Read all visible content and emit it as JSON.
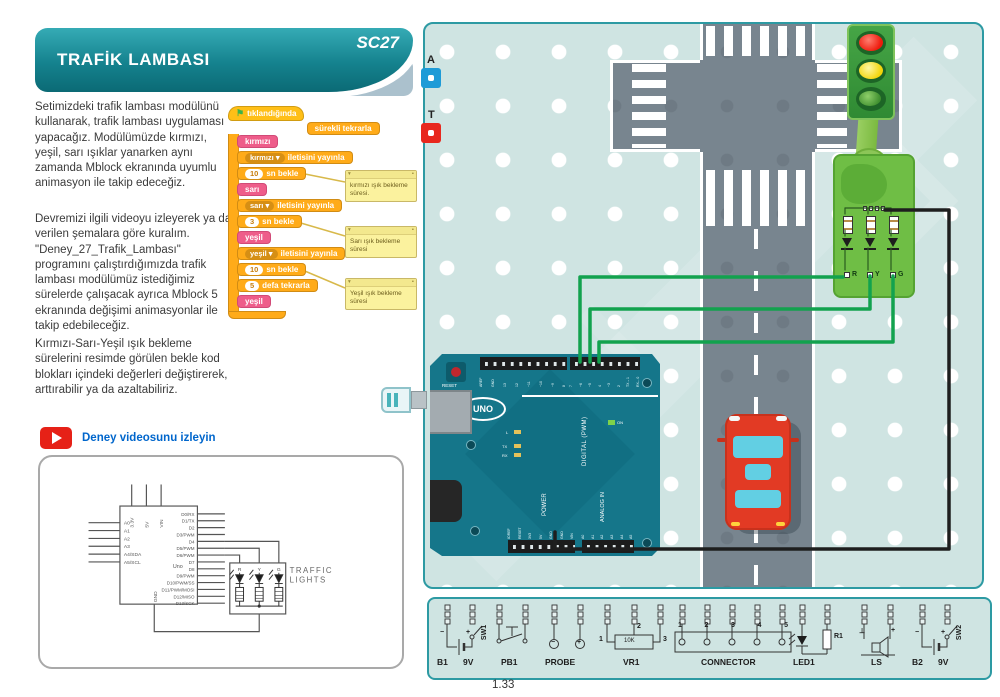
{
  "header": {
    "title": "TRAFİK LAMBASI",
    "code": "SC27"
  },
  "intro": {
    "p1": "Setimizdeki trafik lambası modülünü kullanarak, trafik lambası uygulaması yapacağız. Modülümüzde kırmızı, yeşil, sarı ışıklar yanarken aynı zamanda Mblock ekranında uyumlu animasyon ile takip edeceğiz.",
    "p2": "Devremizi ilgili videoyu izleyerek ya da verilen şemalara göre kuralım. \"Deney_27_Trafik_Lambası\" programını çalıştırdığımızda trafik lambası modülümüz istediğimiz sürelerde çalışacak ayrıca Mblock 5 ekranında değişimi animasyonlar ile takip edebileceğiz.",
    "p3": "Kırmızı-Sarı-Yeşil ışık bekleme sürelerini resimde görülen bekle kod blokları içindeki değerleri değiştirerek, arttırabilir ya da azaltabiliriz."
  },
  "video": {
    "label": "Deney videosunu izleyin"
  },
  "icons": {
    "green_flag": "⚑",
    "caret": "▾",
    "note_collapse": "▾",
    "note_mark": "▪"
  },
  "scratch": {
    "hat": "tıklandığında",
    "forever": "sürekli tekrarla",
    "rows": [
      {
        "text": "kırmızı"
      },
      {
        "dropdown": "kırmızı",
        "text": "iletisini yayınla"
      },
      {
        "value": "10",
        "text": "sn bekle"
      },
      {
        "text": "sarı"
      },
      {
        "dropdown": "sarı",
        "text": "iletisini yayınla"
      },
      {
        "value": "3",
        "text": "sn bekle"
      },
      {
        "text": "yeşil"
      },
      {
        "dropdown": "yeşil",
        "text": "iletisini yayınla"
      },
      {
        "value": "10",
        "text": "sn bekle"
      },
      {
        "value": "5",
        "text": "defa tekrarla"
      },
      {
        "text": "yeşil"
      }
    ],
    "notes": [
      "kırmızı ışık bekleme süresi.",
      "Sarı ışık bekleme süresi",
      "Yeşil ışık bekleme süresi"
    ]
  },
  "schematic": {
    "chip": "Uno",
    "gnd": "GND",
    "top_pins": [
      "3.3V",
      "5V",
      "VIN"
    ],
    "left_pins": [
      "A0",
      "A1",
      "A2",
      "A3",
      "A4/SDA",
      "A5/SCL"
    ],
    "right_pins": [
      "D0/RX",
      "D1/TX",
      "D2",
      "D3/PWM",
      "D4",
      "D5/PWM",
      "D6/PWM",
      "D7",
      "D8",
      "D9/PWM",
      "D10/PWM/SS",
      "D11/PWM/MOSI",
      "D12/MISO",
      "D13/SCK"
    ],
    "module_title1": "TRAFFIC",
    "module_title2": "LIGHTS",
    "leds": [
      "R",
      "Y",
      "G"
    ]
  },
  "board": {
    "marker_a": "A",
    "marker_t": "T",
    "module_leds": [
      "R",
      "Y",
      "G"
    ],
    "arduino": {
      "reset": "RESET",
      "logo": "UNO",
      "digital": "DIGITAL (PWM)",
      "power": "POWER",
      "analog": "ANALOG IN",
      "on": "ON",
      "l": "L",
      "tx": "TX",
      "rx": "RX",
      "top_left_pins": [
        "AREF",
        "GND",
        "13",
        "12",
        "~11",
        "~10",
        "~9",
        "8"
      ],
      "top_right_pins": [
        "7",
        "~6",
        "~5",
        "4",
        "~3",
        "2",
        "TX→1",
        "RX←0"
      ],
      "power_pins": [
        "IOREF",
        "RESET",
        "3V3",
        "5V",
        "GND",
        "GND",
        "VIN"
      ],
      "analog_pins": [
        "A0",
        "A1",
        "A2",
        "A3",
        "A4",
        "A5"
      ]
    }
  },
  "strip": {
    "b1": "B1",
    "b1v": "9V",
    "sw1": "SW1",
    "pb1": "PB1",
    "probe": "PROBE",
    "vr1": "VR1",
    "vr1_value": "10K",
    "vr1_pins": [
      "1",
      "2",
      "3"
    ],
    "connector": "CONNECTOR",
    "connector_pins": [
      "1",
      "2",
      "3",
      "4",
      "5"
    ],
    "led1": "LED1",
    "r1": "R1",
    "ls": "LS",
    "ls_left": "⊥",
    "ls_right": "+",
    "b2": "B2",
    "b2v": "9V",
    "sw2": "SW2",
    "minus": "−",
    "plus": "+"
  },
  "page_number": "1.33",
  "colors": {
    "banner_teal": "#15828e",
    "accent_gray": "#abc1cd",
    "pegboard": "#cfe4e2",
    "road": "#78858f",
    "wire_green": "#12a24e",
    "module_green": "#6fbe45",
    "arduino_teal": "#15768a",
    "block_orange": "#ffab19",
    "block_pink": "#ee5d8a",
    "note_yellow": "#fbf29e",
    "link_blue": "#0066cc",
    "play_red": "#e62117"
  }
}
